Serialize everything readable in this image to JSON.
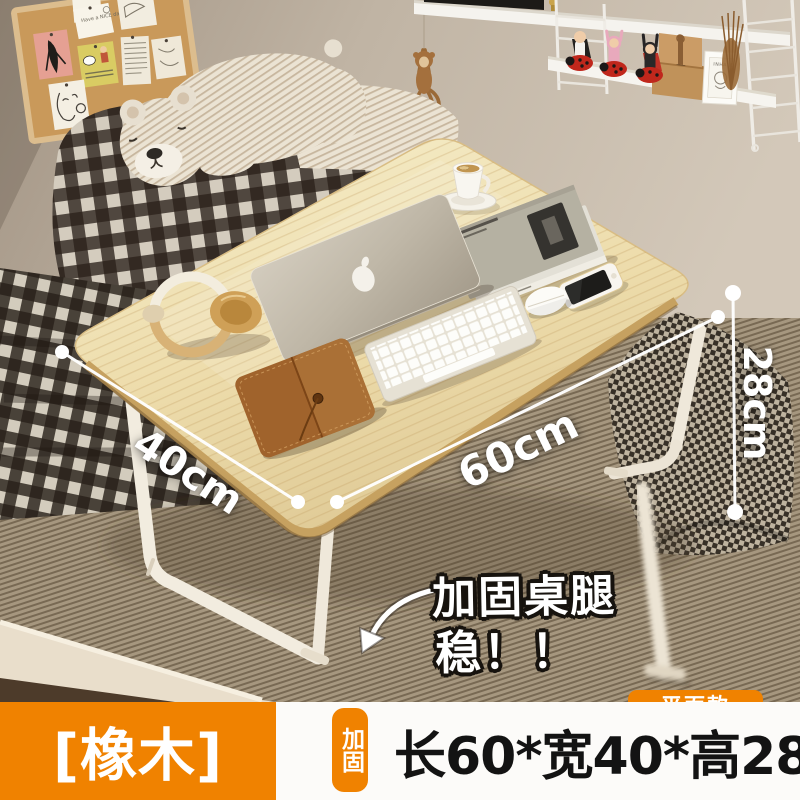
{
  "annotations": {
    "width_label": "40cm",
    "length_label": "60cm",
    "height_label": "28cm",
    "callout_line1": "加固桌腿",
    "callout_line2": "稳！！"
  },
  "scene_text": {
    "corkboard_note": "Have a NICE day!",
    "frame_print": "INHALE"
  },
  "bottom_bar": {
    "variant_label": "[橡木]",
    "reinforce_badge": "加固",
    "spec_text": "长60*宽40*高28",
    "style_badge": "平面款"
  },
  "colors": {
    "accent_orange": "#f08200",
    "panel_white": "#fcfbf9",
    "spec_text_color": "#131313",
    "table_wood": "#eeddab",
    "annotation_white": "#ffffff"
  }
}
